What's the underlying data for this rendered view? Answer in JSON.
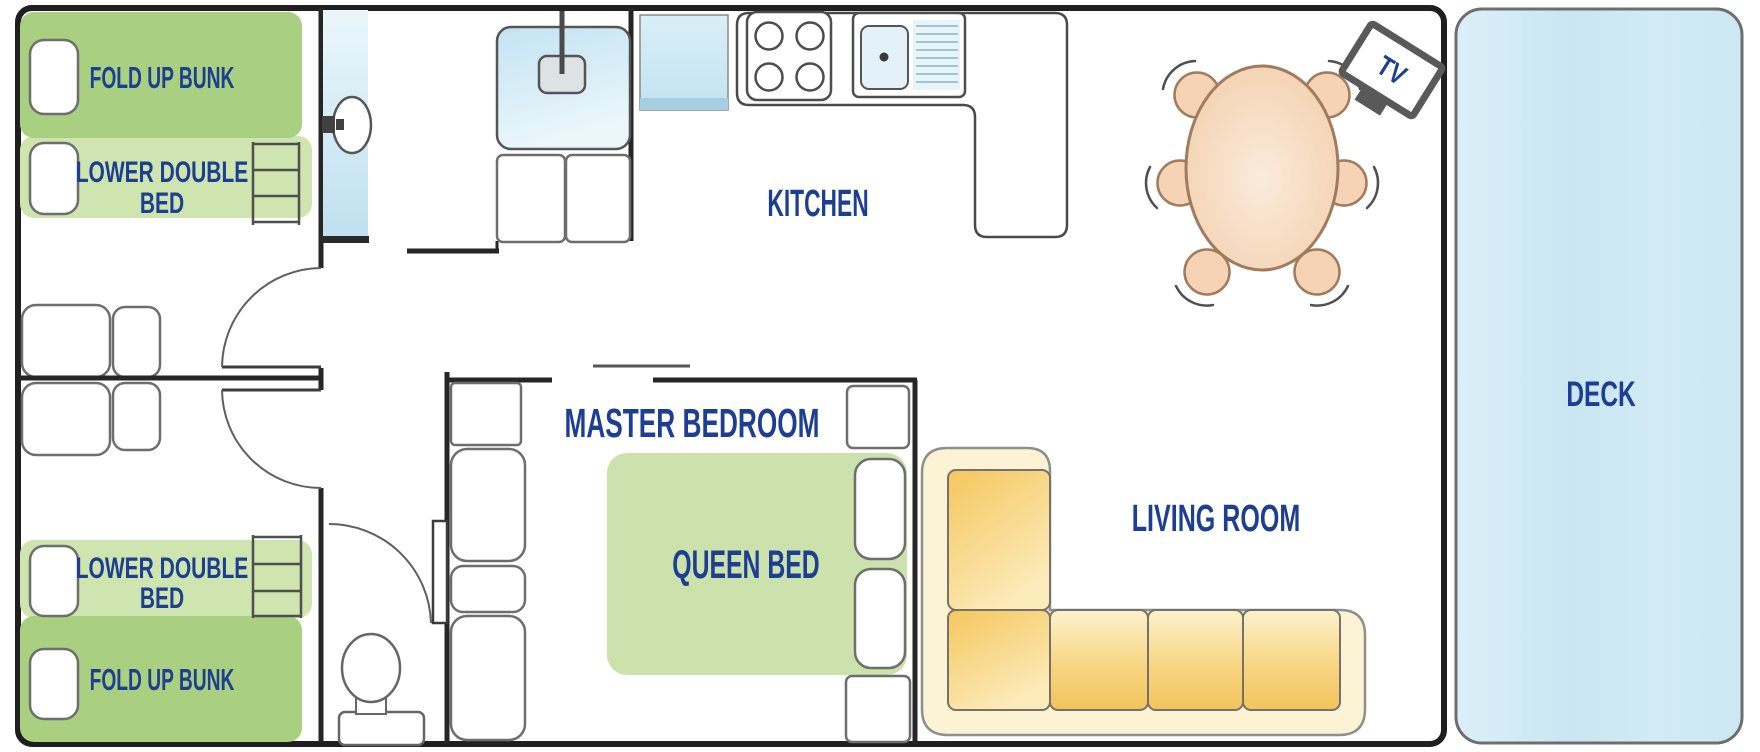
{
  "labels": {
    "fold_up_bunk_top": "FOLD UP BUNK",
    "lower_double_top_l1": "LOWER DOUBLE",
    "lower_double_top_l2": "BED",
    "lower_double_bottom_l1": "LOWER DOUBLE",
    "lower_double_bottom_l2": "BED",
    "fold_up_bunk_bottom": "FOLD UP BUNK",
    "kitchen": "KITCHEN",
    "master_bedroom": "MASTER BEDROOM",
    "queen_bed": "QUEEN BED",
    "living_room": "LIVING ROOM",
    "tv": "TV",
    "deck": "DECK"
  },
  "colors": {
    "label_text": "#1d3e91",
    "bunk_dark_green": "#a9cf80",
    "bunk_light_green": "#cfe5af",
    "queen_bed_green": "#cbe2ac",
    "deck_blue": "#cde8f4",
    "fixture_blue": "#cfe9f5",
    "sofa_base_cream": "#fbf3d3",
    "sofa_cushion_yellow": "#f6cd67",
    "table_peach": "#f5d3b4",
    "wall_dark": "#262626",
    "furniture_outline": "#6e6e6e"
  },
  "furniture": [
    "fold-up-bunk-bed",
    "lower-double-bed",
    "bunk-ladder",
    "pillow",
    "cabin-seat",
    "interior-door",
    "shower",
    "wash-basin",
    "vanity-cabinet",
    "toilet",
    "fridge",
    "stove-cooktop",
    "kitchen-sink",
    "kitchen-counter",
    "dining-table",
    "dining-chair",
    "tv",
    "l-shaped-sofa",
    "sofa-cushion",
    "queen-bed",
    "wardrobe",
    "deck"
  ]
}
